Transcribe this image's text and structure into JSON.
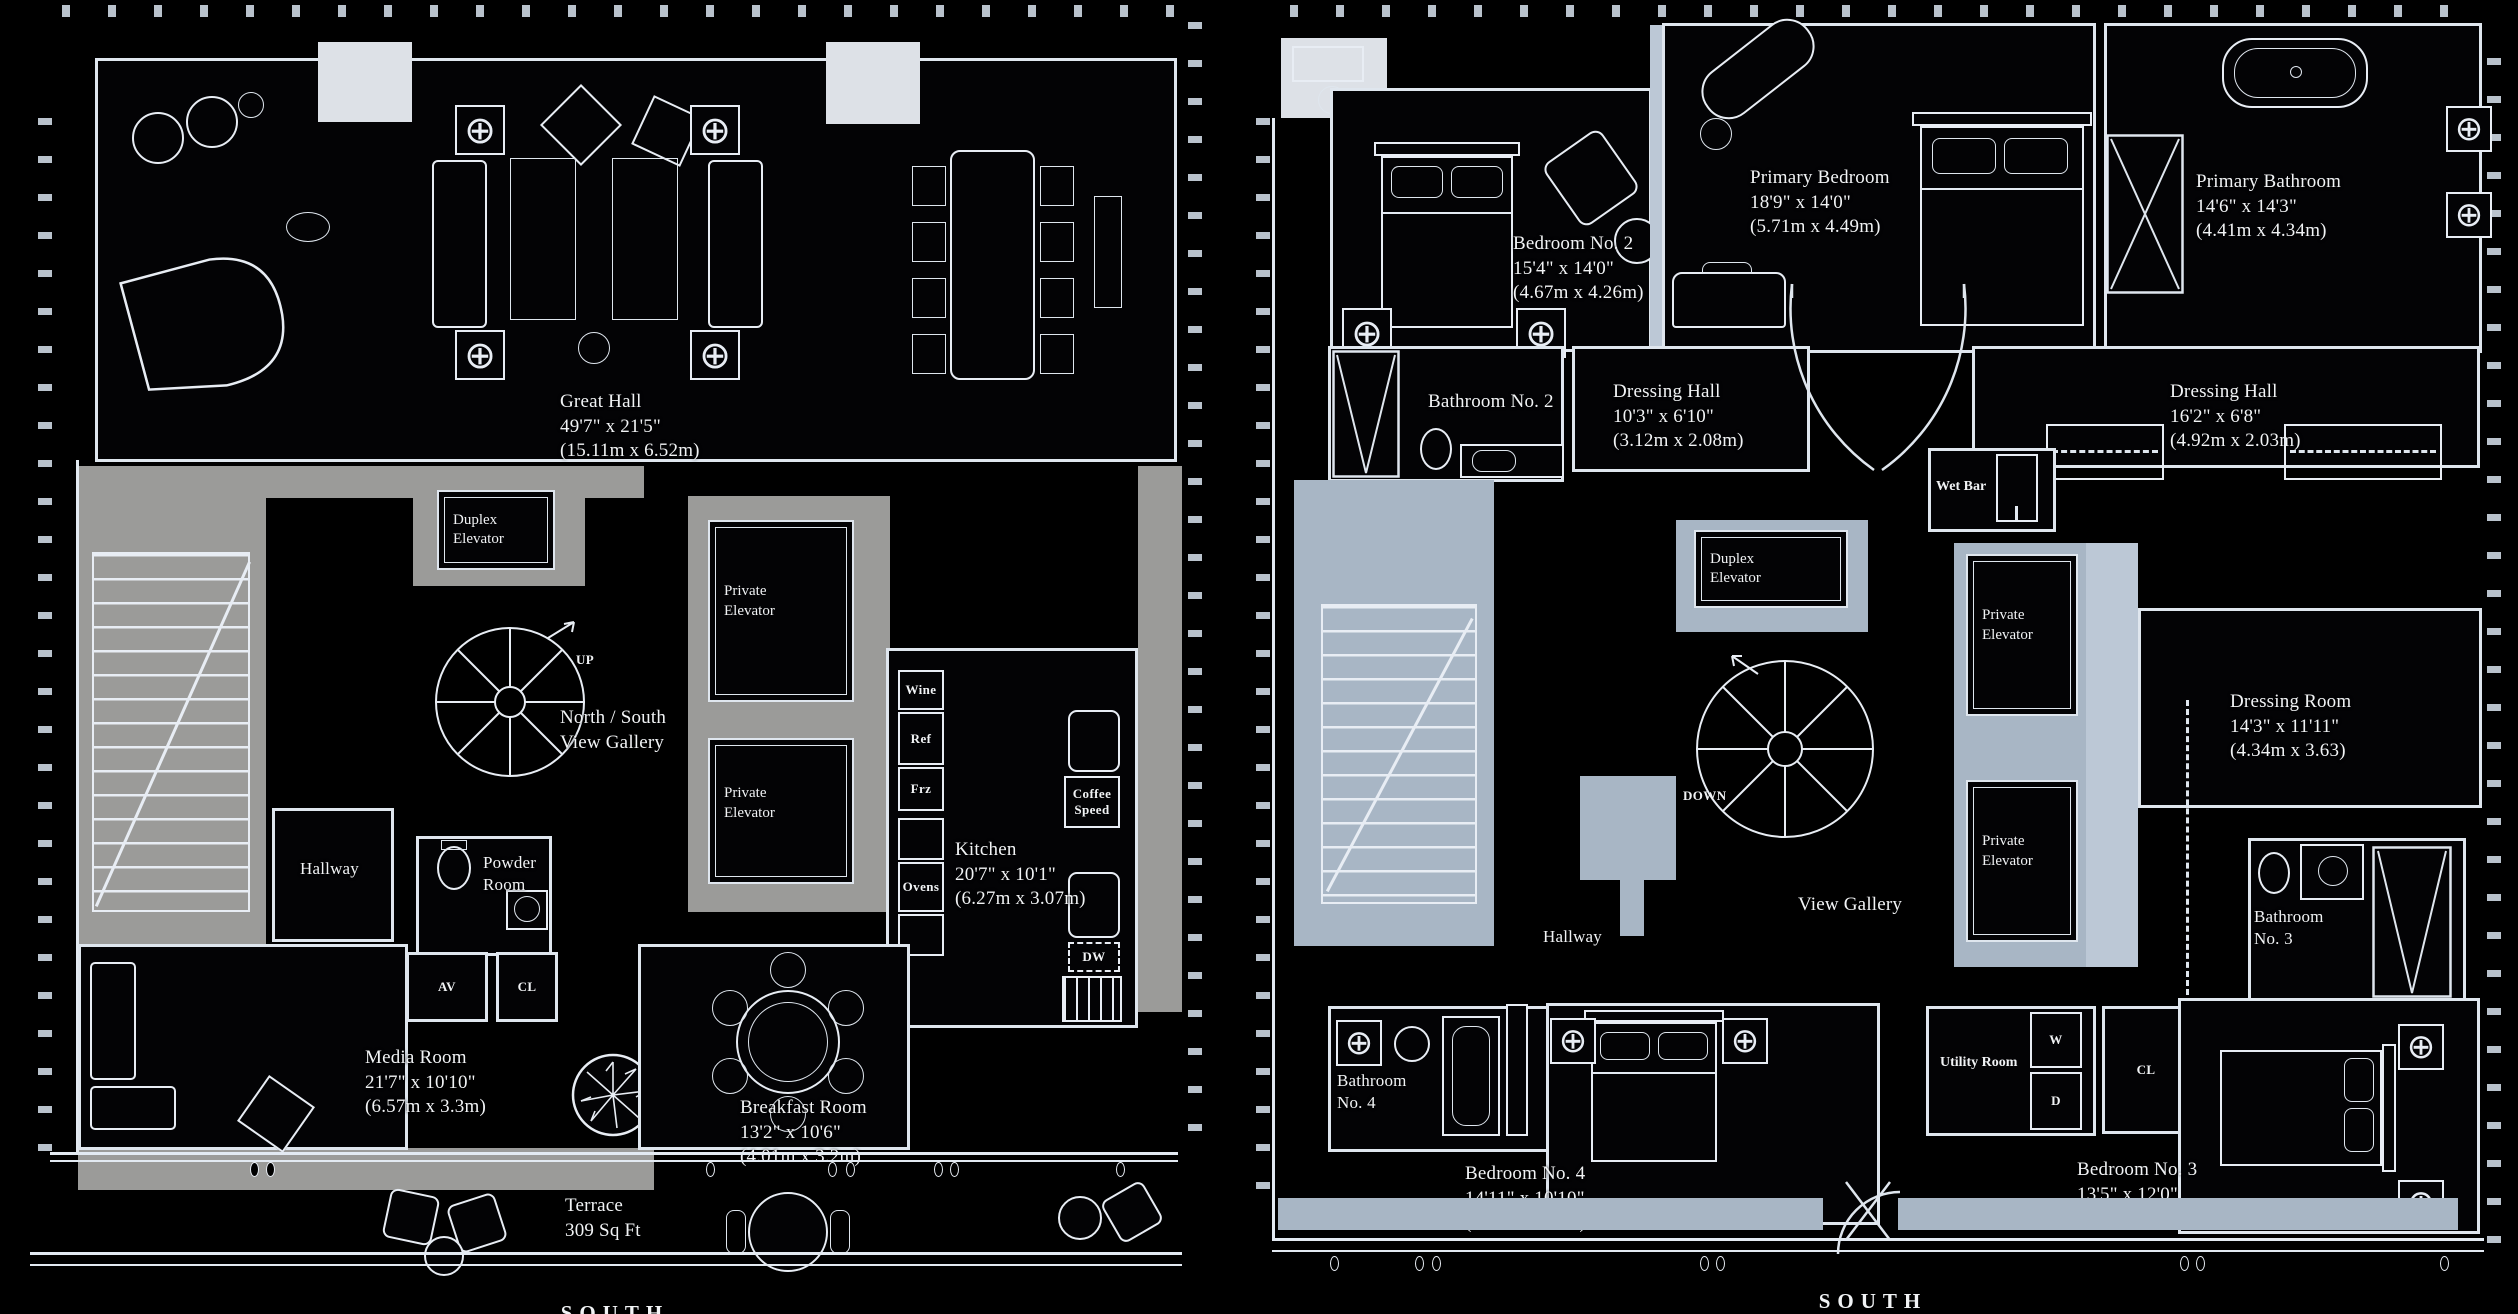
{
  "compass": {
    "left_south": "SOUTH",
    "right_south": "SOUTH"
  },
  "colors": {
    "background": "#000000",
    "wall_line": "#dfe6ee",
    "poche_gray": "#9b9b99",
    "poche_blue_gray": "#a8b6c5",
    "poche_light_blue": "#bcc8d6",
    "light_block": "#dde1e7",
    "label_text": "#f1f3f5"
  },
  "lower_level": {
    "great_hall": {
      "name": "Great Hall",
      "imperial": "49'7\" x 21'5\"",
      "metric": "(15.11m x 6.52m)"
    },
    "duplex_elevator": "Duplex Elevator",
    "private_elevator": "Private Elevator",
    "view_gallery": "North / South View Gallery",
    "up": "UP",
    "kitchen": {
      "name": "Kitchen",
      "imperial": "20'7\" x 10'1\"",
      "metric": "(6.27m x 3.07m)"
    },
    "wine": "Wine",
    "ref": "Ref",
    "frz": "Frz",
    "ovens": "Ovens",
    "coffee": "Coffee Speed",
    "dw": "DW",
    "hallway": "Hallway",
    "powder_room": "Powder Room",
    "av": "AV",
    "cl": "CL",
    "media_room": {
      "name": "Media Room",
      "imperial": "21'7\" x 10'10\"",
      "metric": "(6.57m x 3.3m)"
    },
    "breakfast_room": {
      "name": "Breakfast Room",
      "imperial": "13'2\" x 10'6\"",
      "metric": "(4.01m x 3.2m)"
    },
    "terrace": {
      "name": "Terrace",
      "area": "309 Sq Ft"
    }
  },
  "upper_level": {
    "bedroom_2": {
      "name": "Bedroom No. 2",
      "imperial": "15'4\" x 14'0\"",
      "metric": "(4.67m x 4.26m)"
    },
    "primary_bedroom": {
      "name": "Primary Bedroom",
      "imperial": "18'9\" x 14'0\"",
      "metric": "(5.71m x 4.49m)"
    },
    "primary_bathroom": {
      "name": "Primary Bathroom",
      "imperial": "14'6\" x 14'3\"",
      "metric": "(4.41m x 4.34m)"
    },
    "bathroom_2": "Bathroom No. 2",
    "dressing_hall_small": {
      "name": "Dressing Hall",
      "imperial": "10'3\" x 6'10\"",
      "metric": "(3.12m x 2.08m)"
    },
    "dressing_hall_large": {
      "name": "Dressing Hall",
      "imperial": "16'2\" x 6'8\"",
      "metric": "(4.92m x 2.03m)"
    },
    "wet_bar": "Wet Bar",
    "duplex_elevator": "Duplex Elevator",
    "private_elevator": "Private Elevator",
    "dressing_room": {
      "name": "Dressing Room",
      "imperial": "14'3\" x 11'11\"",
      "metric": "(4.34m x 3.63)"
    },
    "down": "DOWN",
    "view_gallery": "View Gallery",
    "bathroom_3": "Bathroom No. 3",
    "hallway": "Hallway",
    "bathroom_4": "Bathroom No. 4",
    "bedroom_4": {
      "name": "Bedroom No. 4",
      "imperial": "14'11\" x 10'10\"",
      "metric": "(4.54m x 3.3m)"
    },
    "utility_room": "Utility Room",
    "washer": "W",
    "dryer": "D",
    "closet": "CL",
    "bedroom_3": {
      "name": "Bedroom No. 3",
      "imperial": "13'5\" x 12'0\"",
      "metric": "(4.08m x 3.65m)"
    }
  }
}
